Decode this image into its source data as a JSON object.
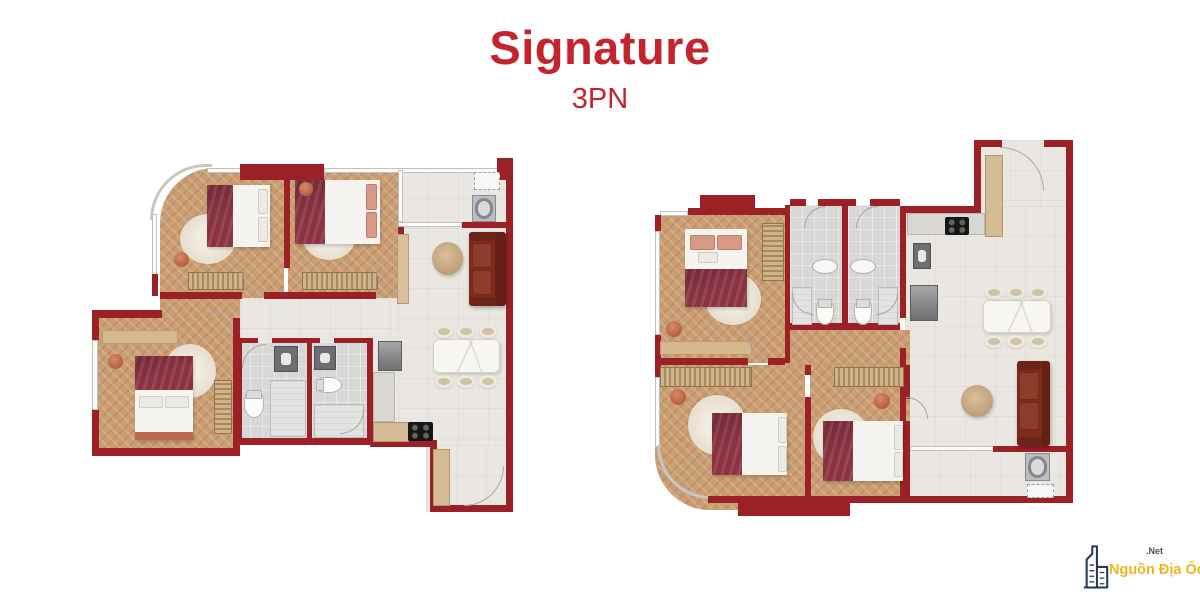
{
  "header": {
    "title": "Signature",
    "subtitle": "3PN"
  },
  "watermark": {
    "brand": "Nguồn Địa Ốc",
    "suffix": ".Net",
    "icon": "building-icon"
  },
  "palette": {
    "title_red": "#c5242e",
    "wall_red": "#9b2127",
    "sofa_red": "#7c2b1f",
    "bed_blanket_red": "#8c3343",
    "pink_pillow": "#d79a87",
    "wood_floor": "#cb9d72",
    "tile_floor": "#eae7e2",
    "bathroom_tile": "#d7d7d5",
    "rug_cream": "#ede6d8",
    "terracotta": "#c06a4f",
    "watermark_yellow": "#f0b41f",
    "watermark_navy": "#223a57"
  },
  "plans": [
    {
      "id": "unit-a",
      "side": "left"
    },
    {
      "id": "unit-b",
      "side": "right"
    }
  ]
}
